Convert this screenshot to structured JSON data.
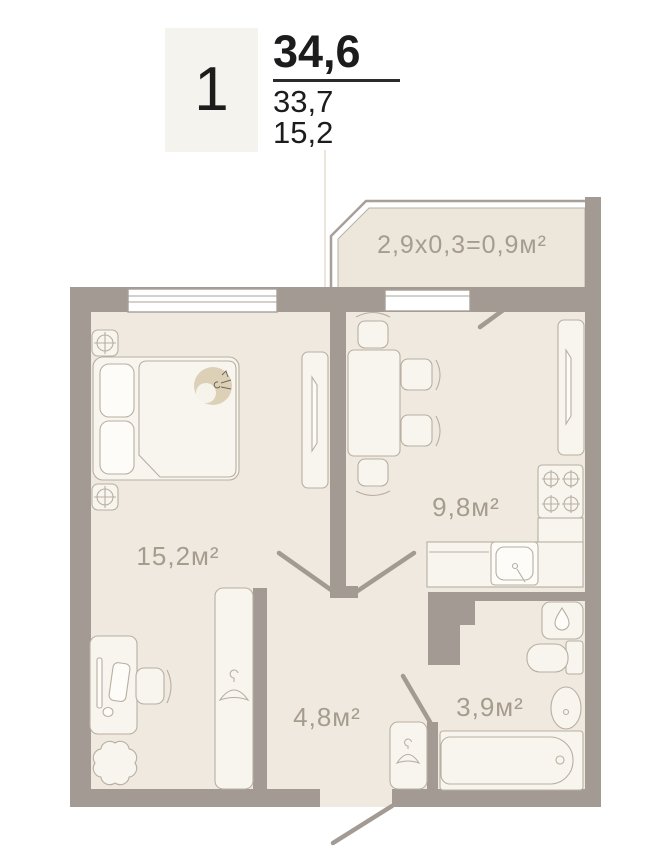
{
  "header": {
    "unit_number": "1",
    "area_total": "34,6",
    "area_living": "33,7",
    "area_room": "15,2"
  },
  "rooms": {
    "balcony": {
      "label": "2,9х0,3=0,9м²"
    },
    "living_room": {
      "label": "15,2м²"
    },
    "kitchen": {
      "label": "9,8м²"
    },
    "hallway": {
      "label": "4,8м²"
    },
    "bathroom": {
      "label": "3,9м²"
    }
  },
  "icons": {
    "lamp": "crosshair-circle",
    "burner": "crosshair-circle",
    "hanger": "coat-hanger",
    "water_heater": "water-drop"
  },
  "colors": {
    "wall": "#a39b93",
    "floor": "#efe9e0",
    "furniture": "#f8f5ee",
    "room_label": "#a69c8e",
    "header_text": "#1c1c1c",
    "header_box": "#f5f3ed",
    "background": "#ffffff"
  }
}
